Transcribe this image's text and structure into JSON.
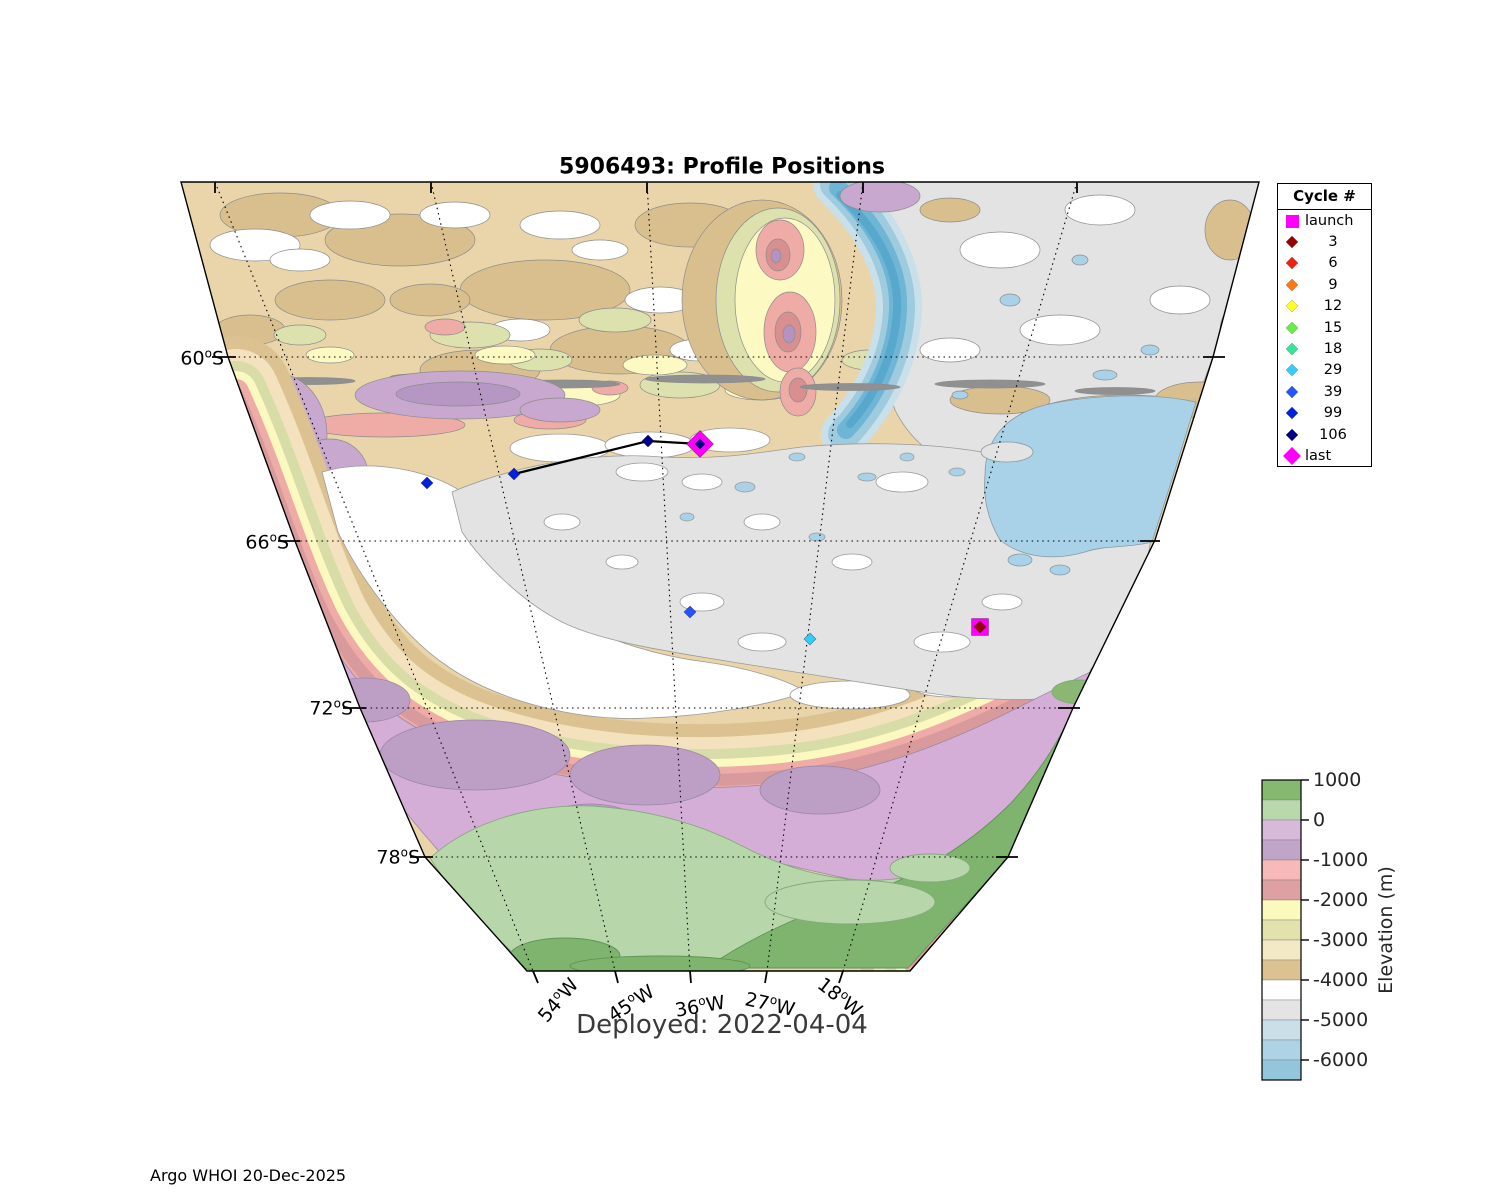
{
  "title": "5906493: Profile Positions",
  "deployed_label": "Deployed: 2022-04-04",
  "credit": "Argo WHOI 20-Dec-2025",
  "legend": {
    "title": "Cycle #",
    "entries": [
      {
        "label": "launch",
        "color": "#ff00ff",
        "marker": "square"
      },
      {
        "label": "3",
        "color": "#990000",
        "marker": "diamond"
      },
      {
        "label": "6",
        "color": "#ee2211",
        "marker": "diamond"
      },
      {
        "label": "9",
        "color": "#ff7711",
        "marker": "diamond"
      },
      {
        "label": "12",
        "color": "#ffff22",
        "marker": "diamond"
      },
      {
        "label": "15",
        "color": "#66ee44",
        "marker": "diamond"
      },
      {
        "label": "18",
        "color": "#33e699",
        "marker": "diamond"
      },
      {
        "label": "29",
        "color": "#33ccff",
        "marker": "diamond"
      },
      {
        "label": "39",
        "color": "#2255ff",
        "marker": "diamond"
      },
      {
        "label": "99",
        "color": "#0022dd",
        "marker": "diamond"
      },
      {
        "label": "106",
        "color": "#000088",
        "marker": "diamond"
      },
      {
        "label": "last",
        "color": "#ff00ff",
        "marker": "diamond-large"
      }
    ]
  },
  "colorbar": {
    "label": "Elevation (m)",
    "ticks": [
      "1000",
      "0",
      "-1000",
      "-2000",
      "-3000",
      "-4000",
      "-5000",
      "-6000"
    ],
    "segments": [
      "#85b96f",
      "#b9d8ab",
      "#d7b9da",
      "#c1a5c9",
      "#f7b9ba",
      "#dfa0a3",
      "#fcf9bd",
      "#e4e2ac",
      "#f4e9c5",
      "#dcc291",
      "#ffffff",
      "#e4e4e4",
      "#cbdfe9",
      "#aed3e4",
      "#93c6dc"
    ]
  },
  "axes": {
    "lat": [
      {
        "deg": "60",
        "hem": "S"
      },
      {
        "deg": "66",
        "hem": "S"
      },
      {
        "deg": "72",
        "hem": "S"
      },
      {
        "deg": "78",
        "hem": "S"
      }
    ],
    "lon": [
      {
        "deg": "54",
        "hem": "W"
      },
      {
        "deg": "45",
        "hem": "W"
      },
      {
        "deg": "36",
        "hem": "W"
      },
      {
        "deg": "27",
        "hem": "W"
      },
      {
        "deg": "18",
        "hem": "W"
      }
    ]
  },
  "map": {
    "trajectory": [
      [
        514,
        474
      ],
      [
        648,
        441
      ],
      [
        700,
        444
      ]
    ],
    "markers": [
      {
        "cycle": "launch",
        "shape": "square",
        "color": "#ff00ff",
        "x": 980,
        "y": 627,
        "size": 17
      },
      {
        "cycle": "3",
        "shape": "diamond",
        "color": "#990000",
        "x": 980,
        "y": 627,
        "size": 12
      },
      {
        "cycle": "29",
        "shape": "diamond",
        "color": "#33ccff",
        "x": 810,
        "y": 639,
        "size": 12
      },
      {
        "cycle": "39",
        "shape": "diamond",
        "color": "#2255ff",
        "x": 690,
        "y": 612,
        "size": 12
      },
      {
        "cycle": "99",
        "shape": "diamond",
        "color": "#0022dd",
        "x": 427,
        "y": 483,
        "size": 12
      },
      {
        "cycle": "99",
        "shape": "diamond",
        "color": "#0022dd",
        "x": 514,
        "y": 474,
        "size": 12
      },
      {
        "cycle": "106",
        "shape": "diamond",
        "color": "#000088",
        "x": 648,
        "y": 441,
        "size": 12
      },
      {
        "cycle": "last",
        "shape": "diamond",
        "color": "#ff00ff",
        "x": 700,
        "y": 444,
        "size": 27
      },
      {
        "cycle": "106",
        "shape": "diamond",
        "color": "#000088",
        "x": 700,
        "y": 444,
        "size": 10
      }
    ]
  }
}
